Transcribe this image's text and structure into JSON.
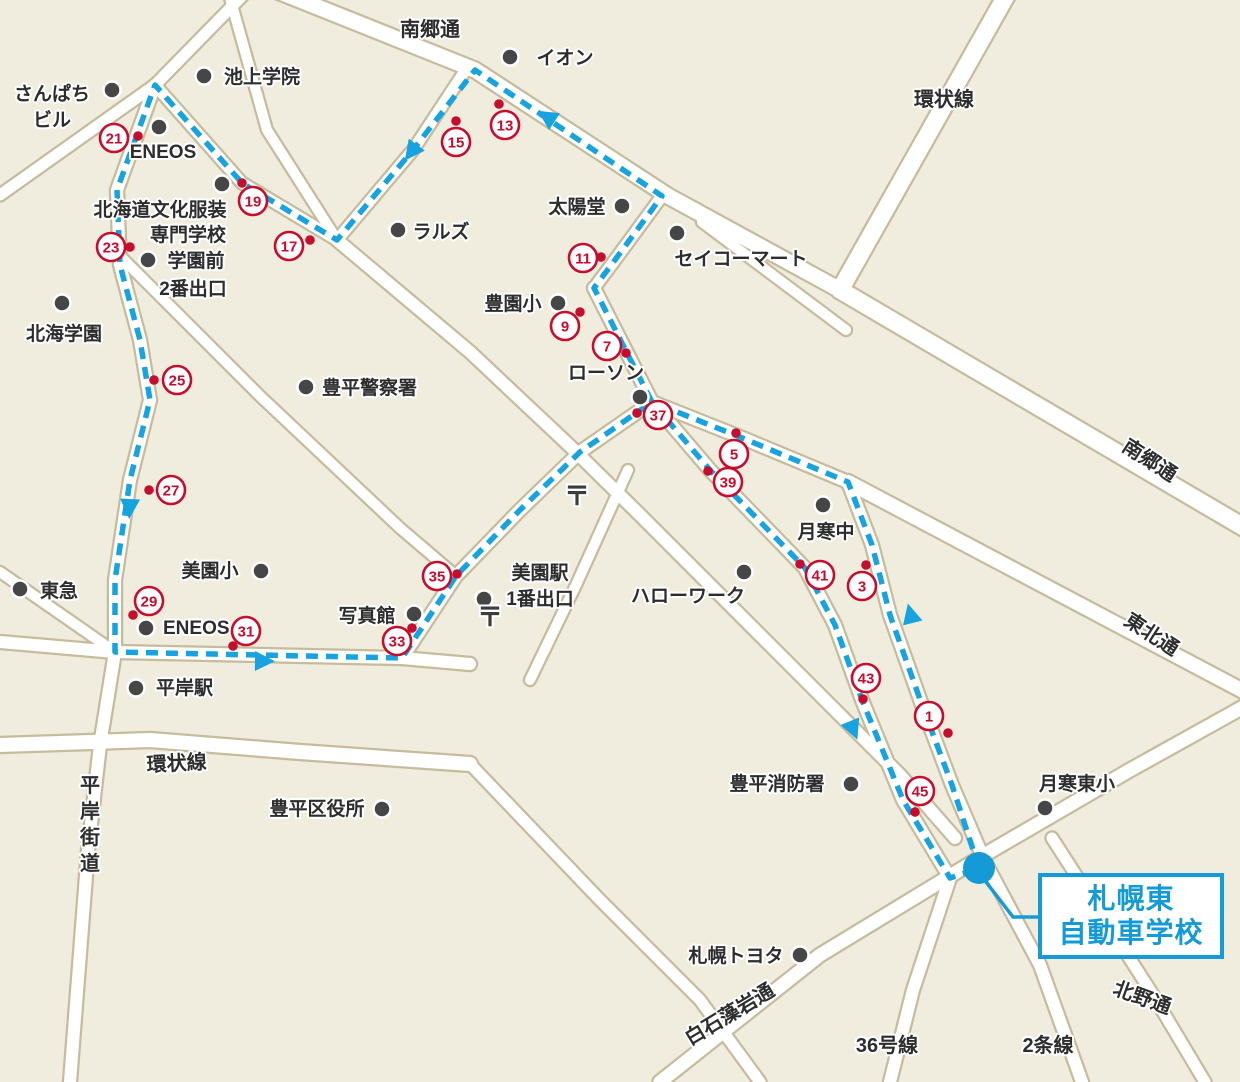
{
  "colors": {
    "bg": "#f1edde",
    "road_fill": "#ffffff",
    "road_border": "#c6bb9d",
    "route": "#17a2e0",
    "waypoint_red": "#c50e2e",
    "landmark_dot": "#464646",
    "label_text": "#2d2d2d",
    "school_blue": "#149bd7"
  },
  "school_callout": {
    "line1": "札幌東",
    "line2": "自動車学校"
  },
  "school_marker": {
    "cx": 979,
    "cy": 868,
    "r": 16,
    "leader": [
      [
        983,
        878
      ],
      [
        1013,
        917
      ],
      [
        1040,
        917
      ]
    ],
    "box": {
      "x": 1038,
      "y": 873,
      "w": 186,
      "h": 86
    }
  },
  "roads": [
    {
      "pts": [
        [
          250,
          -20
        ],
        [
          475,
          70
        ],
        [
          668,
          196
        ],
        [
          840,
          290
        ]
      ],
      "w": 15
    },
    {
      "pts": [
        [
          1015,
          -20
        ],
        [
          840,
          290
        ]
      ],
      "w": 17
    },
    {
      "pts": [
        [
          840,
          290
        ],
        [
          1245,
          528
        ]
      ],
      "w": 17
    },
    {
      "pts": [
        [
          848,
          482
        ],
        [
          1245,
          692
        ]
      ],
      "w": 14
    },
    {
      "pts": [
        [
          594,
          288
        ],
        [
          652,
          402
        ],
        [
          740,
          437
        ],
        [
          848,
          482
        ]
      ],
      "w": 12
    },
    {
      "pts": [
        [
          662,
          196
        ],
        [
          612,
          264
        ],
        [
          594,
          288
        ]
      ],
      "w": 11
    },
    {
      "pts": [
        [
          467,
          68
        ],
        [
          413,
          150
        ],
        [
          337,
          240
        ]
      ],
      "w": 11
    },
    {
      "pts": [
        [
          225,
          -20
        ],
        [
          267,
          130
        ],
        [
          337,
          240
        ]
      ],
      "w": 10
    },
    {
      "pts": [
        [
          155,
          85
        ],
        [
          242,
          183
        ],
        [
          337,
          240
        ]
      ],
      "w": 11
    },
    {
      "pts": [
        [
          0,
          195
        ],
        [
          155,
          85
        ],
        [
          248,
          -10
        ]
      ],
      "w": 11
    },
    {
      "pts": [
        [
          155,
          85
        ],
        [
          117,
          190
        ],
        [
          120,
          265
        ],
        [
          140,
          340
        ],
        [
          150,
          400
        ],
        [
          130,
          480
        ],
        [
          115,
          580
        ],
        [
          115,
          652
        ],
        [
          100,
          745
        ],
        [
          88,
          850
        ],
        [
          70,
          1082
        ]
      ],
      "w": 12
    },
    {
      "pts": [
        [
          702,
          222
        ],
        [
          846,
          330
        ]
      ],
      "w": 10
    },
    {
      "pts": [
        [
          337,
          240
        ],
        [
          470,
          352
        ],
        [
          572,
          448
        ],
        [
          640,
          515
        ],
        [
          700,
          575
        ],
        [
          760,
          635
        ],
        [
          900,
          775
        ],
        [
          955,
          838
        ]
      ],
      "w": 12
    },
    {
      "pts": [
        [
          122,
          258
        ],
        [
          260,
          396
        ],
        [
          400,
          528
        ],
        [
          455,
          575
        ]
      ],
      "w": 10
    },
    {
      "pts": [
        [
          402,
          658
        ],
        [
          456,
          576
        ],
        [
          520,
          510
        ],
        [
          580,
          452
        ],
        [
          652,
          402
        ]
      ],
      "w": 12
    },
    {
      "pts": [
        [
          652,
          402
        ],
        [
          710,
          470
        ],
        [
          805,
          568
        ],
        [
          835,
          625
        ],
        [
          862,
          700
        ],
        [
          903,
          800
        ],
        [
          950,
          878
        ]
      ],
      "w": 12
    },
    {
      "pts": [
        [
          848,
          482
        ],
        [
          872,
          545
        ],
        [
          890,
          615
        ],
        [
          922,
          705
        ],
        [
          952,
          785
        ],
        [
          985,
          862
        ]
      ],
      "w": 12
    },
    {
      "pts": [
        [
          0,
          642
        ],
        [
          115,
          652
        ],
        [
          402,
          658
        ],
        [
          470,
          664
        ]
      ],
      "w": 12
    },
    {
      "pts": [
        [
          0,
          572
        ],
        [
          115,
          652
        ]
      ],
      "w": 10
    },
    {
      "pts": [
        [
          0,
          745
        ],
        [
          150,
          740
        ],
        [
          300,
          752
        ],
        [
          470,
          764
        ]
      ],
      "w": 14
    },
    {
      "pts": [
        [
          628,
          470
        ],
        [
          576,
          585
        ],
        [
          530,
          680
        ]
      ],
      "w": 10
    },
    {
      "pts": [
        [
          470,
          764
        ],
        [
          600,
          900
        ],
        [
          700,
          1000
        ],
        [
          760,
          1082
        ]
      ],
      "w": 11
    },
    {
      "pts": [
        [
          660,
          1082
        ],
        [
          820,
          955
        ],
        [
          996,
          848
        ],
        [
          1130,
          770
        ],
        [
          1245,
          706
        ]
      ],
      "w": 13
    },
    {
      "pts": [
        [
          950,
          878
        ],
        [
          913,
          990
        ],
        [
          890,
          1082
        ]
      ],
      "w": 12
    },
    {
      "pts": [
        [
          985,
          862
        ],
        [
          1040,
          965
        ],
        [
          1082,
          1082
        ]
      ],
      "w": 12
    },
    {
      "pts": [
        [
          1052,
          838
        ],
        [
          1150,
          990
        ],
        [
          1205,
          1082
        ]
      ],
      "w": 11
    }
  ],
  "route": {
    "width": 5.5,
    "dash": "12 8",
    "points": [
      [
        979,
        868
      ],
      [
        952,
        785
      ],
      [
        922,
        705
      ],
      [
        890,
        615
      ],
      [
        872,
        545
      ],
      [
        848,
        482
      ],
      [
        740,
        437
      ],
      [
        652,
        402
      ],
      [
        594,
        288
      ],
      [
        612,
        264
      ],
      [
        662,
        196
      ],
      [
        475,
        70
      ],
      [
        413,
        150
      ],
      [
        337,
        240
      ],
      [
        242,
        183
      ],
      [
        155,
        85
      ],
      [
        117,
        190
      ],
      [
        120,
        265
      ],
      [
        140,
        340
      ],
      [
        150,
        400
      ],
      [
        130,
        480
      ],
      [
        115,
        580
      ],
      [
        115,
        652
      ],
      [
        402,
        658
      ],
      [
        456,
        576
      ],
      [
        520,
        510
      ],
      [
        580,
        452
      ],
      [
        652,
        402
      ],
      [
        710,
        470
      ],
      [
        805,
        568
      ],
      [
        835,
        625
      ],
      [
        862,
        700
      ],
      [
        903,
        800
      ],
      [
        950,
        878
      ],
      [
        975,
        870
      ]
    ],
    "arrows": [
      {
        "x": 552,
        "y": 120,
        "a": 213
      },
      {
        "x": 415,
        "y": 147,
        "a": 127
      },
      {
        "x": 130,
        "y": 502,
        "a": 93
      },
      {
        "x": 258,
        "y": 661,
        "a": 1
      },
      {
        "x": 851,
        "y": 724,
        "a": 68
      },
      {
        "x": 912,
        "y": 620,
        "a": 256
      }
    ]
  },
  "waypoints": [
    {
      "n": "1",
      "x": 929,
      "y": 716,
      "dx": 948,
      "dy": 733
    },
    {
      "n": "3",
      "x": 862,
      "y": 586,
      "dx": 866,
      "dy": 565
    },
    {
      "n": "5",
      "x": 734,
      "y": 454,
      "dx": 736,
      "dy": 433
    },
    {
      "n": "7",
      "x": 607,
      "y": 346,
      "dx": 626,
      "dy": 353
    },
    {
      "n": "9",
      "x": 565,
      "y": 326,
      "dx": 580,
      "dy": 312
    },
    {
      "n": "11",
      "x": 583,
      "y": 258,
      "dx": 601,
      "dy": 257
    },
    {
      "n": "13",
      "x": 505,
      "y": 125,
      "dx": 499,
      "dy": 104
    },
    {
      "n": "15",
      "x": 456,
      "y": 142,
      "dx": 456,
      "dy": 121
    },
    {
      "n": "17",
      "x": 289,
      "y": 246,
      "dx": 310,
      "dy": 240
    },
    {
      "n": "19",
      "x": 253,
      "y": 201,
      "dx": 242,
      "dy": 183
    },
    {
      "n": "21",
      "x": 114,
      "y": 138,
      "dx": 138,
      "dy": 136
    },
    {
      "n": "23",
      "x": 111,
      "y": 247,
      "dx": 130,
      "dy": 247
    },
    {
      "n": "25",
      "x": 177,
      "y": 380,
      "dx": 154,
      "dy": 380
    },
    {
      "n": "27",
      "x": 171,
      "y": 490,
      "dx": 149,
      "dy": 490
    },
    {
      "n": "29",
      "x": 149,
      "y": 601,
      "dx": 133,
      "dy": 615
    },
    {
      "n": "31",
      "x": 246,
      "y": 631,
      "dx": 233,
      "dy": 646
    },
    {
      "n": "33",
      "x": 397,
      "y": 641,
      "dx": 412,
      "dy": 628
    },
    {
      "n": "35",
      "x": 437,
      "y": 576,
      "dx": 457,
      "dy": 574
    },
    {
      "n": "37",
      "x": 658,
      "y": 415,
      "dx": 637,
      "dy": 413
    },
    {
      "n": "39",
      "x": 728,
      "y": 482,
      "dx": 708,
      "dy": 471
    },
    {
      "n": "41",
      "x": 820,
      "y": 575,
      "dx": 800,
      "dy": 564
    },
    {
      "n": "43",
      "x": 866,
      "y": 678,
      "dx": 863,
      "dy": 699
    },
    {
      "n": "45",
      "x": 920,
      "y": 791,
      "dx": 915,
      "dy": 812
    }
  ],
  "landmarks": [
    {
      "id": "ikegami-gakuin",
      "dot": [
        204,
        76
      ],
      "anchor": "start",
      "texts": [
        {
          "t": "池上学院",
          "x": 224,
          "y": 83
        }
      ]
    },
    {
      "id": "sanpachi-biru",
      "dot": [
        112,
        90
      ],
      "anchor": "middle",
      "texts": [
        {
          "t": "さんぱち",
          "x": 52,
          "y": 100
        },
        {
          "t": "ビル",
          "x": 52,
          "y": 126
        }
      ]
    },
    {
      "id": "eneos-north",
      "dot": [
        159,
        127
      ],
      "anchor": "middle",
      "texts": [
        {
          "t": "ENEOS",
          "x": 163,
          "y": 158
        }
      ]
    },
    {
      "id": "bunka-fukusou",
      "dot": [
        222,
        184
      ],
      "anchor": "middle",
      "texts": [
        {
          "t": "北海道文化服装",
          "x": 160,
          "y": 216
        },
        {
          "t": "専門学校",
          "x": 188,
          "y": 241
        }
      ]
    },
    {
      "id": "gakuenmae-exit2",
      "dot": [
        148,
        260
      ],
      "anchor": "middle",
      "texts": [
        {
          "t": "学園前",
          "x": 196,
          "y": 267
        },
        {
          "t": "2番出口",
          "x": 193,
          "y": 295
        }
      ]
    },
    {
      "id": "hokkai-gakuen",
      "dot": [
        62,
        303
      ],
      "anchor": "middle",
      "texts": [
        {
          "t": "北海学園",
          "x": 64,
          "y": 340
        }
      ]
    },
    {
      "id": "aeon",
      "dot": [
        510,
        57
      ],
      "anchor": "middle",
      "texts": [
        {
          "t": "イオン",
          "x": 565,
          "y": 64
        }
      ]
    },
    {
      "id": "taiyodo",
      "dot": [
        622,
        206
      ],
      "anchor": "middle",
      "texts": [
        {
          "t": "太陽堂",
          "x": 577,
          "y": 213
        }
      ]
    },
    {
      "id": "ralse",
      "dot": [
        398,
        230
      ],
      "anchor": "middle",
      "texts": [
        {
          "t": "ラルズ",
          "x": 441,
          "y": 238
        }
      ]
    },
    {
      "id": "seicomart",
      "dot": [
        677,
        233
      ],
      "anchor": "middle",
      "texts": [
        {
          "t": "セイコーマート",
          "x": 741,
          "y": 265
        }
      ]
    },
    {
      "id": "hoen-sho",
      "dot": [
        558,
        303
      ],
      "anchor": "middle",
      "texts": [
        {
          "t": "豊園小",
          "x": 513,
          "y": 310
        }
      ]
    },
    {
      "id": "lawson",
      "dot": [
        640,
        397
      ],
      "anchor": "middle",
      "texts": [
        {
          "t": "ローソン",
          "x": 606,
          "y": 379
        }
      ]
    },
    {
      "id": "toyohira-police",
      "dot": [
        306,
        387
      ],
      "anchor": "start",
      "texts": [
        {
          "t": "豊平警察署",
          "x": 322,
          "y": 394
        }
      ]
    },
    {
      "id": "tsukisamu-chu",
      "dot": [
        823,
        505
      ],
      "anchor": "middle",
      "texts": [
        {
          "t": "月寒中",
          "x": 826,
          "y": 538
        }
      ]
    },
    {
      "id": "tokyu",
      "dot": [
        20,
        589
      ],
      "anchor": "start",
      "texts": [
        {
          "t": "東急",
          "x": 40,
          "y": 597
        }
      ]
    },
    {
      "id": "misono-sho",
      "dot": [
        261,
        571
      ],
      "anchor": "middle",
      "texts": [
        {
          "t": "美園小",
          "x": 210,
          "y": 577
        }
      ]
    },
    {
      "id": "eneos-south",
      "dot": [
        146,
        628
      ],
      "anchor": "start",
      "texts": [
        {
          "t": "ENEOS",
          "x": 163,
          "y": 634
        }
      ]
    },
    {
      "id": "shashinkan",
      "dot": [
        414,
        614
      ],
      "anchor": "middle",
      "texts": [
        {
          "t": "写真館",
          "x": 367,
          "y": 622
        }
      ]
    },
    {
      "id": "misono-sta-exit1",
      "dot": [
        484,
        599
      ],
      "anchor": "middle",
      "texts": [
        {
          "t": "美園駅",
          "x": 540,
          "y": 579
        },
        {
          "t": "1番出口",
          "x": 540,
          "y": 605
        }
      ]
    },
    {
      "id": "hellowork",
      "dot": [
        744,
        572
      ],
      "anchor": "middle",
      "texts": [
        {
          "t": "ハローワーク",
          "x": 688,
          "y": 602
        }
      ]
    },
    {
      "id": "hiragishi-sta",
      "dot": [
        136,
        688
      ],
      "anchor": "start",
      "texts": [
        {
          "t": "平岸駅",
          "x": 156,
          "y": 694
        }
      ]
    },
    {
      "id": "toyohira-kuyakusho",
      "dot": [
        382,
        809
      ],
      "anchor": "middle",
      "texts": [
        {
          "t": "豊平区役所",
          "x": 317,
          "y": 815
        }
      ]
    },
    {
      "id": "toyohira-fire",
      "dot": [
        851,
        784
      ],
      "anchor": "middle",
      "texts": [
        {
          "t": "豊平消防署",
          "x": 777,
          "y": 790
        }
      ]
    },
    {
      "id": "tsukisamu-higashi-sho",
      "dot": [
        1045,
        808
      ],
      "anchor": "middle",
      "texts": [
        {
          "t": "月寒東小",
          "x": 1077,
          "y": 790
        }
      ]
    },
    {
      "id": "sapporo-toyota",
      "dot": [
        800,
        955
      ],
      "anchor": "middle",
      "texts": [
        {
          "t": "札幌トヨタ",
          "x": 736,
          "y": 962
        }
      ]
    }
  ],
  "road_labels": [
    {
      "text": "南郷通",
      "x": 430,
      "y": 36,
      "rot": 0
    },
    {
      "text": "環状線",
      "x": 944,
      "y": 106,
      "rot": 0
    },
    {
      "text": "南郷通",
      "x": 1146,
      "y": 466,
      "rot": 33
    },
    {
      "text": "東北通",
      "x": 1148,
      "y": 640,
      "rot": 33
    },
    {
      "text": "環状線",
      "x": 177,
      "y": 770,
      "rot": -3
    },
    {
      "text": "平岸街道",
      "x": 90,
      "y": 792,
      "rot": 0,
      "vertical": true
    },
    {
      "text": "白石藻岩通",
      "x": 733,
      "y": 1020,
      "rot": -31
    },
    {
      "text": "36号線",
      "x": 887,
      "y": 1052,
      "rot": 0
    },
    {
      "text": "2条線",
      "x": 1048,
      "y": 1052,
      "rot": 0
    },
    {
      "text": "北野通",
      "x": 1140,
      "y": 1004,
      "rot": 20
    }
  ],
  "post_marks": [
    {
      "x": 577,
      "y": 505
    },
    {
      "x": 490,
      "y": 626
    }
  ]
}
